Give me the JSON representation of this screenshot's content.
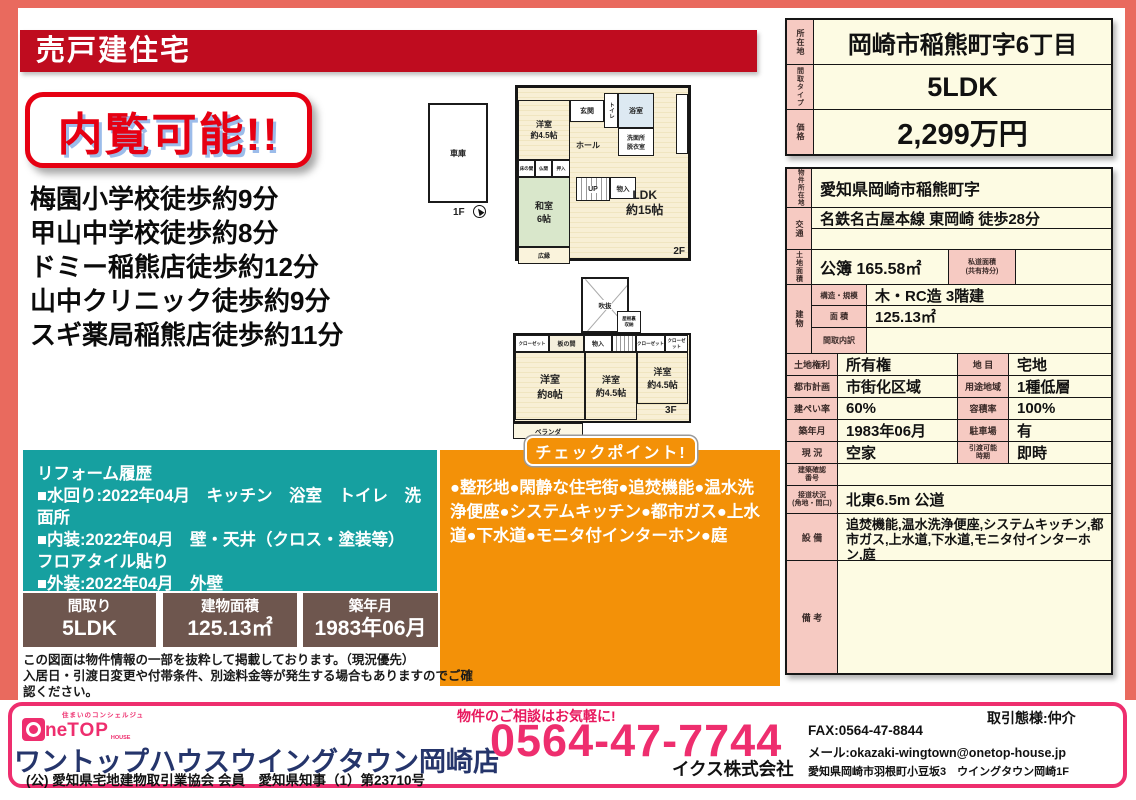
{
  "colors": {
    "frame": "#e96a5e",
    "banner_bg": "#bf0c1f",
    "badge_red": "#e60012",
    "teal": "#16a0a0",
    "orange": "#f39108",
    "brown": "#6e564e",
    "footer_pink": "#ee2e6e",
    "store_navy": "#25356b",
    "cell_pink": "#f6cac2",
    "cell_cream": "#fdfbe3"
  },
  "header": {
    "banner": "売戸建住宅",
    "badge": "内覧可能!!"
  },
  "walk": [
    "梅園小学校徒歩約9分",
    "甲山中学校徒歩約8分",
    "ドミー稲熊店徒歩約12分",
    "山中クリニック徒歩約9分",
    "スギ薬局稲熊店徒歩約11分"
  ],
  "floorplan": {
    "f1_label": "1F",
    "garage": "車庫",
    "f2_label": "2F",
    "f2": {
      "yoshitsu45": "洋室\n約4.5帖",
      "genkan": "玄関",
      "toilet": "トイレ",
      "bath": "浴室",
      "senmen": "洗面所\n脱衣室",
      "hall": "ホール",
      "tokonoma": "床の間",
      "butsuma": "仏間",
      "oshiire": "押入",
      "washitsu": "和室\n6帖",
      "up": "UP",
      "monoire": "物入",
      "ldk": "LDK\n約15帖",
      "hiroen": "広縁"
    },
    "f3_label": "3F",
    "f3": {
      "fukinuke": "吹抜",
      "yaneura": "屋根裏\n収納",
      "closet": "クローゼット",
      "itanoma": "板の間",
      "monoire": "物入",
      "dn": "DN",
      "closet2": "クローゼット",
      "closet3": "クローゼット",
      "yo8": "洋室\n約8帖",
      "yo45a": "洋室\n約4.5帖",
      "yo45b": "洋室\n約4.5帖",
      "veranda": "ベランダ"
    }
  },
  "reform": {
    "lines": [
      "リフォーム履歴",
      "■水回り:2022年04月　キッチン　浴室　トイレ　洗面所",
      "■内装:2022年04月　壁・天井（クロス・塗装等）　　フロアタイル貼り",
      "■外装:2022年04月　外壁"
    ]
  },
  "checkpoint": {
    "title": "チェックポイント!",
    "body": "●整形地●閑静な住宅街●追焚機能●温水洗浄便座●システムキッチン●都市ガス●上水道●下水道●モニタ付インターホン●庭"
  },
  "stats": [
    {
      "label": "間取り",
      "value": "5LDK"
    },
    {
      "label": "建物面積",
      "value": "125.13㎡"
    },
    {
      "label": "築年月",
      "value": "1983年06月"
    }
  ],
  "disclaimer": [
    "この図面は物件情報の一部を抜粋して掲載しております。（現況優先）",
    "入居日・引渡日変更や付帯条件、別途料金等が発生する場合もありますのでご確認ください。"
  ],
  "summary": {
    "addr_label": "所在地",
    "addr": "岡崎市稲熊町字6丁目",
    "type_label": "間取タイプ",
    "type": "5LDK",
    "price_label": "価格",
    "price": "2,299万円"
  },
  "detail": {
    "loc_label": "物件所在地",
    "loc": "愛知県岡崎市稲熊町字",
    "access_label": "交通",
    "access": "名鉄名古屋本線 東岡崎 徒歩28分",
    "access2": "",
    "land_label": "土地面積",
    "land": "公簿 165.58㎡",
    "road_area_label": "私道面積\n(共有持分)",
    "road_area": "",
    "bldg_label": "建物",
    "structure_label": "構造・規模",
    "structure": "木・RC造 3階建",
    "barea_label": "面 積",
    "barea": "125.13㎡",
    "madori_label": "間取内訳",
    "madori": "",
    "rights_label": "土地権利",
    "rights": "所有権",
    "chimoku_label": "地 目",
    "chimoku": "宅地",
    "city_label": "都市計画",
    "city": "市街化区域",
    "youto_label": "用途地域",
    "youto": "1種低層",
    "kenpei_label": "建ぺい率",
    "kenpei": "60%",
    "youseki_label": "容積率",
    "youseki": "100%",
    "chiku_label": "築年月",
    "chiku": "1983年06月",
    "parking_label": "駐車場",
    "parking": "有",
    "genkyo_label": "現 況",
    "genkyo": "空家",
    "hikiwatashi_label": "引渡可能\n時期",
    "hikiwatashi": "即時",
    "kakunin_label": "建築確認\n番号",
    "kakunin": "",
    "setsudo_label": "接道状況\n(角地・間口)",
    "setsudo": "北東6.5m 公道",
    "setsubi_label": "設 備",
    "setsubi": "追焚機能,温水洗浄便座,システムキッチン,都市ガス,上水道,下水道,モニタ付インターホン,庭",
    "biko_label": "備 考",
    "biko": ""
  },
  "footer": {
    "concierge": "住まいのコンシェルジュ",
    "logo_ne": "ne",
    "logo_top": "TOP",
    "logo_house": "HOUSE",
    "store": "ワントップハウスウイングタウン岡崎店",
    "assoc": "(公) 愛知県宅地建物取引業協会 会員　愛知県知事（1）第23710号",
    "consult": "物件のご相談はお気軽に!",
    "phone": "0564-47-7744",
    "deal": "取引態様:仲介",
    "fax": "FAX:0564-47-8844",
    "mail": "メール:okazaki-wingtown@onetop-house.jp",
    "company": "イクス株式会社",
    "address": "愛知県岡崎市羽根町小豆坂3　ウイングタウン岡崎1F"
  }
}
